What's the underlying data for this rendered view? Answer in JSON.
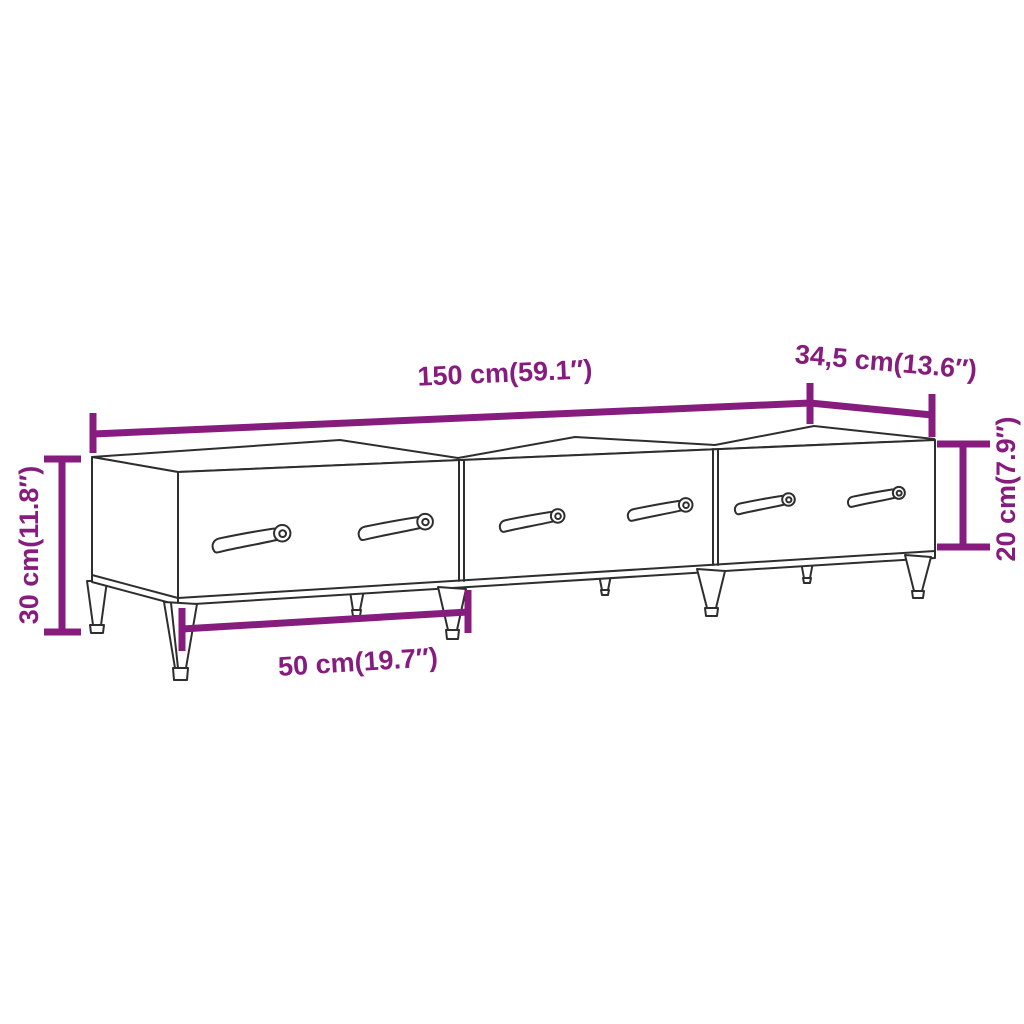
{
  "product_diagram": {
    "subject": "tv-cabinet-with-three-drawers-line-drawing",
    "colors": {
      "dimension_accent": "#861c7d",
      "drawing_line": "#2e2e2e",
      "background": "#ffffff"
    },
    "dimensions": {
      "width": {
        "label": "150 cm(59.1″)"
      },
      "depth": {
        "label": "34,5 cm(13.6″)"
      },
      "height": {
        "label": "30 cm(11.8″)"
      },
      "body_height": {
        "label": "20 cm(7.9″)"
      },
      "drawer_width": {
        "label": "50 cm(19.7″)"
      }
    }
  }
}
